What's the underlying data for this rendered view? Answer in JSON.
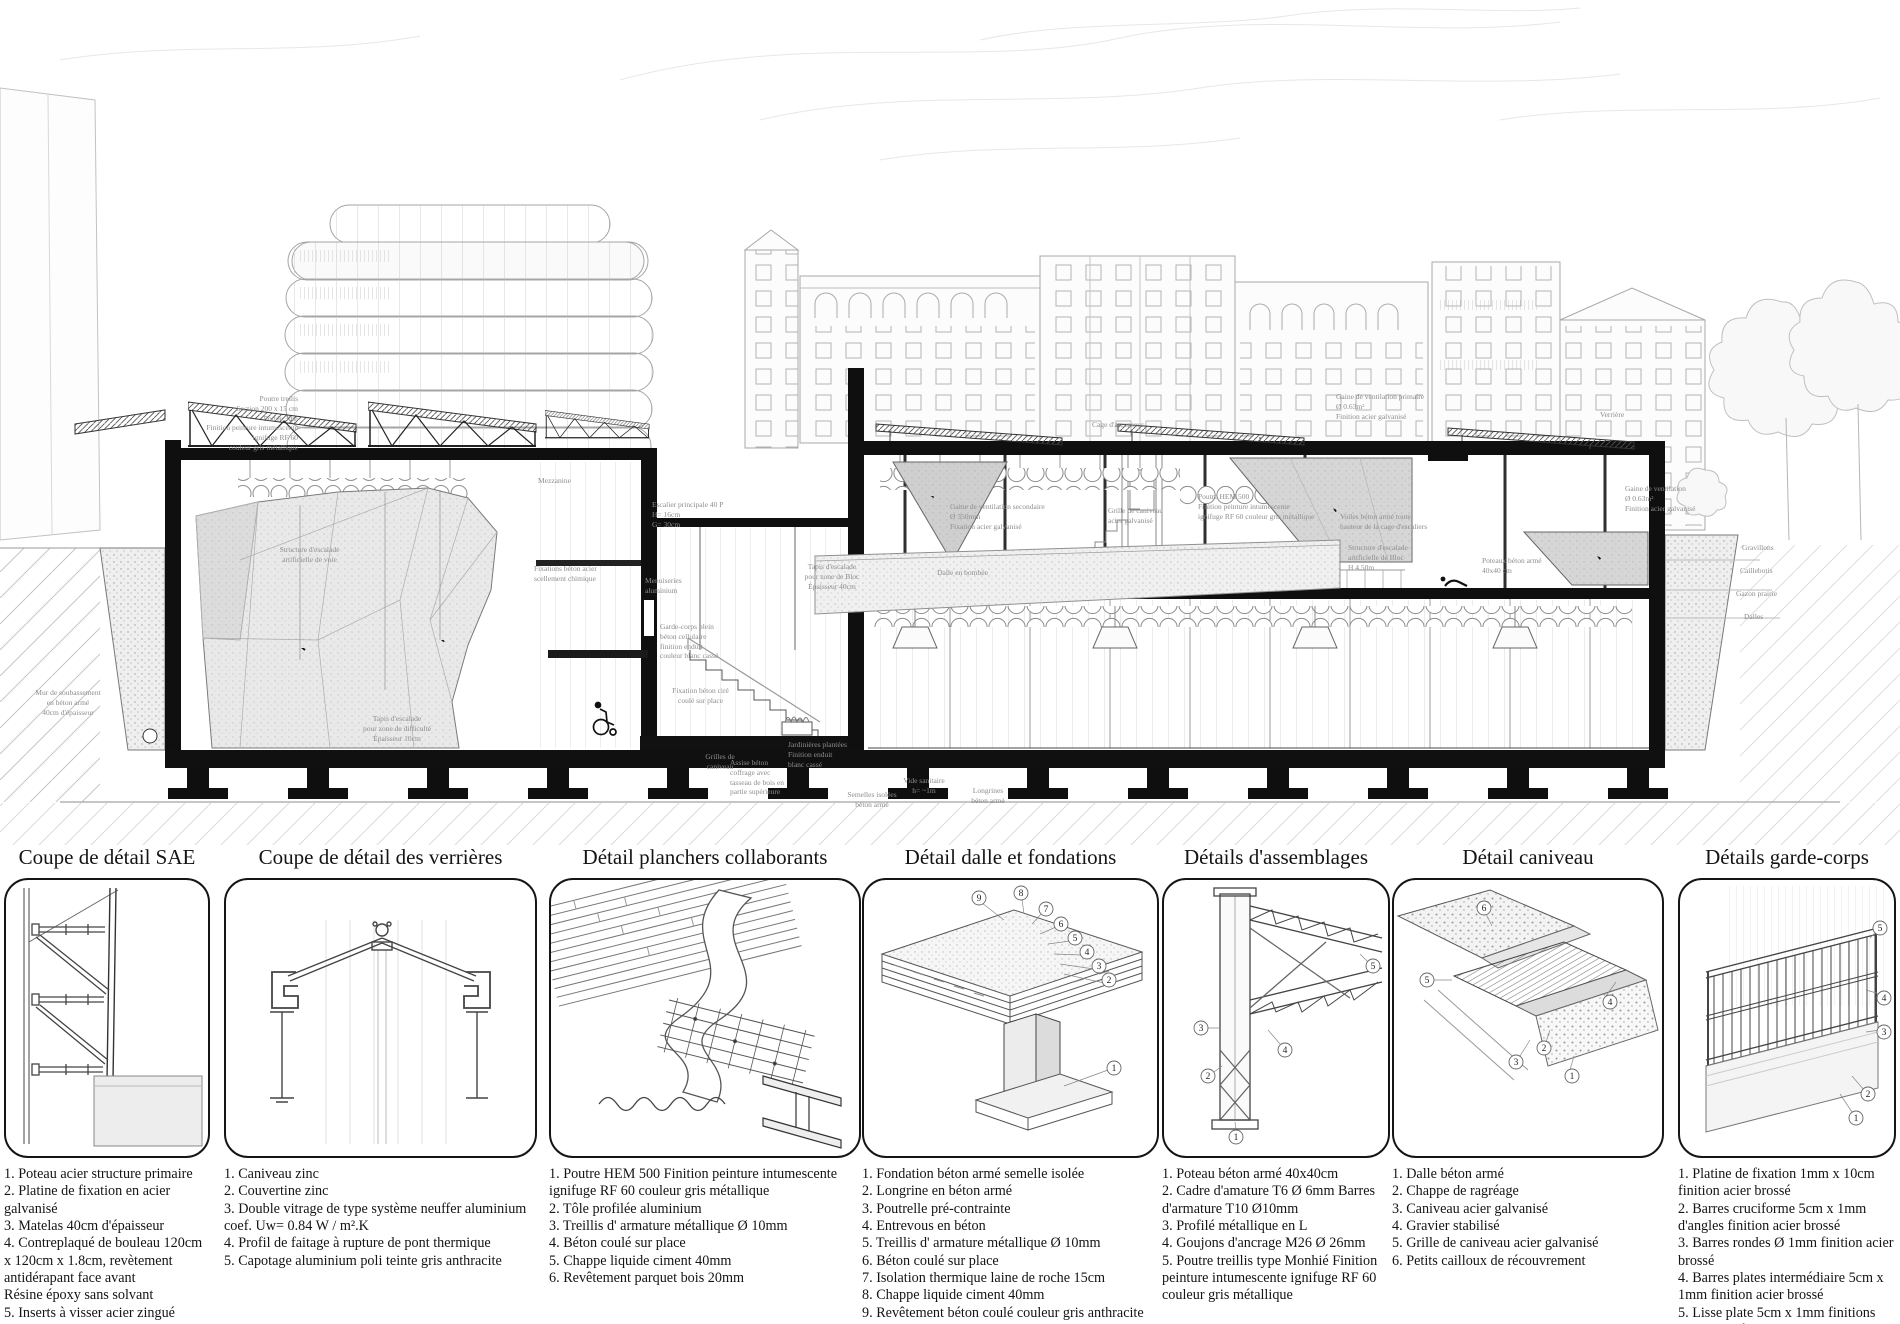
{
  "section": {
    "labels": [
      {
        "text": "Poutre treilis\nSection 200 x 15 cm\nPortée 30m\nFinition peinture intumescente\nignifuge RF 60\ncouleur gris métallique"
      },
      {
        "text": "Mur de soubassement\nen béton armé\n40cm d'épaisseur"
      },
      {
        "text": "Structure d'escalade\nartificielle de voie"
      },
      {
        "text": "Tapis d'escalade\npour zone de difficulté\nÉpaisseur 10cm"
      },
      {
        "text": "Mezzanine"
      },
      {
        "text": "Fixations béton acier\nscellement chimique"
      },
      {
        "text": "Grilles de\ncaniveau"
      },
      {
        "text": "Garde-corps plein\nbéton cellulaire\nfinition enduit\ncouleur blanc cassé"
      },
      {
        "text": "Escalier principale 40 P\nH= 16cm\nG= 30cm"
      },
      {
        "text": "Fixation béton ciré\ncoulé sur place"
      },
      {
        "text": "Jardinières plantées\nFinition enduit\nblanc cassé"
      },
      {
        "text": "Assise béton\ncoffrage avec\ntasseau de bois en\npartie supérieure"
      },
      {
        "text": "Tapis d'escalade\npour zone de Bloc\nÉpaisseur 40cm"
      },
      {
        "text": "Dalle en bombée"
      },
      {
        "text": "Gaine de ventilation secondaire\nØ 350mm\nFixation acier galvanisé"
      },
      {
        "text": "Grille de caniveau\nacier galvanisé"
      },
      {
        "text": "Poutre HEM 500\nFinition peinture intumescente\nignifuge RF 60 couleur gris métallique"
      },
      {
        "text": "Cage d'ascenseur"
      },
      {
        "text": "Voiles béton armé toute\nhauteur de la cage d'escaliers"
      },
      {
        "text": "Gaine de ventilation primaire\nØ 0.63m²\nFinition acier galvanisé"
      },
      {
        "text": "Poteaux béton armé\n40x40 cm"
      },
      {
        "text": "Structure d'escalade\nartificielle de Bloc\nH 4.50m"
      },
      {
        "text": "Verrière"
      },
      {
        "text": "Gaine de ventilation\nØ 0.63m²\nFinition acier galvanisé"
      },
      {
        "text": "Gravillons"
      },
      {
        "text": "Caillebotis"
      },
      {
        "text": "Gazon prairie"
      },
      {
        "text": "Dalles"
      },
      {
        "text": "Semelles isolées\nbéton armé"
      },
      {
        "text": "Vide sanitaire\nh= ~1m"
      },
      {
        "text": "Longrines\nbéton armé"
      },
      {
        "text": "Menuiseries\naluminium"
      }
    ]
  },
  "panels": [
    {
      "title": "Coupe de détail SAE",
      "legend": [
        "1. Poteau acier structure primaire",
        "2. Platine de fixation en acier galvanisé",
        "3. Matelas 40cm d'épaisseur",
        "4. Contreplaqué de bouleau 120cm x 120cm x 1.8cm, revètement antidérapant face avant",
        "Résine époxy sans solvant",
        "5. Inserts à visser acier zingué",
        "6. Bois d'ossature douglas",
        "Norme NF EN-12 572-2:2017"
      ],
      "callouts": []
    },
    {
      "title": "Coupe de détail des verrières",
      "legend": [
        "1. Caniveau zinc",
        "2. Couvertine zinc",
        "3. Double vitrage de type système neuffer aluminium coef. Uw= 0.84 W / m².K",
        "4. Profil de faitage à rupture de pont thermique",
        "5. Capotage aluminium poli teinte gris anthracite"
      ],
      "callouts": []
    },
    {
      "title": "Détail planchers collaborants",
      "legend": [
        "1. Poutre HEM 500 Finition peinture intumescente ignifuge RF 60 couleur gris métallique",
        "2. Tôle profilée aluminium",
        "3. Treillis d' armature métallique Ø 10mm",
        "4. Béton coulé sur place",
        "5. Chappe liquide ciment 40mm",
        "6. Revêtement parquet bois 20mm"
      ],
      "callouts": []
    },
    {
      "title": "Détail dalle et fondations",
      "legend": [
        "1. Fondation béton armé semelle isolée",
        "2. Longrine en béton armé",
        "3. Poutrelle pré-contrainte",
        "4. Entrevous en béton",
        "5. Treillis d' armature métallique Ø 10mm",
        "6. Béton coulé sur place",
        "7. Isolation thermique laine de roche 15cm",
        "8. Chappe liquide ciment 40mm",
        "9. Revêtement béton coulé couleur gris anthracite"
      ],
      "callouts": [
        "1",
        "2",
        "3",
        "4",
        "5",
        "6",
        "7",
        "8",
        "9"
      ]
    },
    {
      "title": "Détails d'assemblages",
      "legend": [
        "1. Poteau béton armé 40x40cm",
        "2. Cadre d'amature T6 Ø 6mm Barres d'armature T10 Ø10mm",
        "3. Profilé métallique en L",
        "4. Goujons d'ancrage M26 Ø 26mm",
        "5. Poutre treillis type Monhié Finition peinture intumescente ignifuge RF 60 couleur gris métallique"
      ],
      "callouts": [
        "1",
        "2",
        "3",
        "4",
        "5"
      ]
    },
    {
      "title": "Détail caniveau",
      "legend": [
        "1. Dalle béton armé",
        "2. Chappe de ragréage",
        "3. Caniveau acier galvanisé",
        "4. Gravier stabilisé",
        "5. Grille de caniveau acier galvanisé",
        "6. Petits cailloux de récouvrement"
      ],
      "callouts": [
        "1",
        "2",
        "3",
        "4",
        "5",
        "6"
      ]
    },
    {
      "title": "Détails garde-corps",
      "legend": [
        "1. Platine de fixation 1mm x 10cm finition acier brossé",
        "2. Barres cruciforme 5cm x 1mm d'angles finition acier brossé",
        "3. Barres rondes Ø 1mm finition acier brossé",
        "4. Barres plates intermédiaire 5cm x 1mm finition acier brossé",
        "5. Lisse plate 5cm x 1mm finitions acier brossé"
      ],
      "callouts": [
        "1",
        "2",
        "3",
        "4",
        "5"
      ]
    }
  ]
}
